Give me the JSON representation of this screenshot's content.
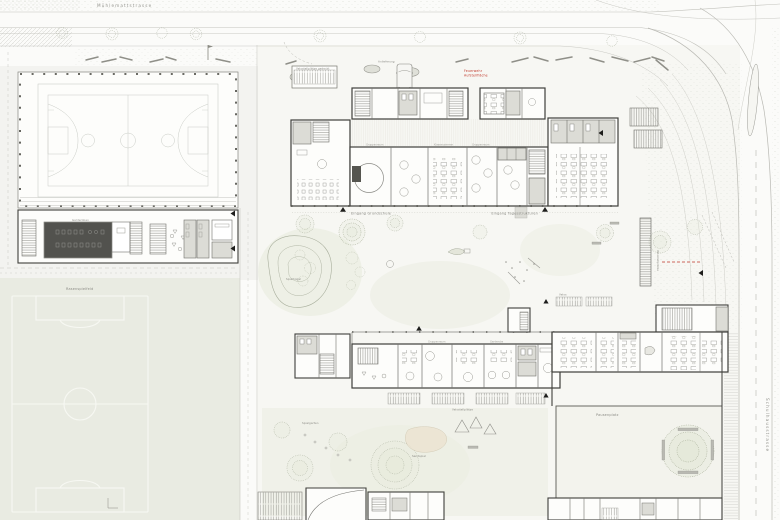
{
  "colors": {
    "paper": "#fbfbf9",
    "field_green": "#e9ebe2",
    "garden_green": "#eef0e6",
    "wall_dark": "#3f3f3b",
    "partition": "#72726d",
    "furniture": "#9a9a94",
    "cell_gray": "#dcdcd6",
    "court_line": "#c9ccc6",
    "accent_red": "#c0392b",
    "tree_stroke": "#a8ae9c"
  },
  "labels": {
    "street_top": "Mühlemattstrasse",
    "street_right": "Schulhausstrasse",
    "entrance_school": "Eingang Grundschule",
    "entrance_daycare": "Eingang Tagesstrukturen",
    "fire1": "Feuerwehr",
    "fire2": "Aufstellfläche",
    "delivery": "Anlieferung",
    "bike_main": "Velostellplätze gedeckt",
    "bike_kiga": "Velostellplätze",
    "bike_path": "Velostellplätze",
    "bike_right": "Velos",
    "garderobe": "Garderoben",
    "field": "Rasenspielfeld",
    "mound": "Spielhügel",
    "sand": "Sandspiel",
    "courtyard": "Pausenplatz",
    "garden": "Spielgarten"
  },
  "rooms": {
    "r1": "Gruppenraum",
    "r2": "Klassenzimmer",
    "r3": "Gruppenraum",
    "k1": "Gruppenraum",
    "k2": "Garderobe"
  }
}
